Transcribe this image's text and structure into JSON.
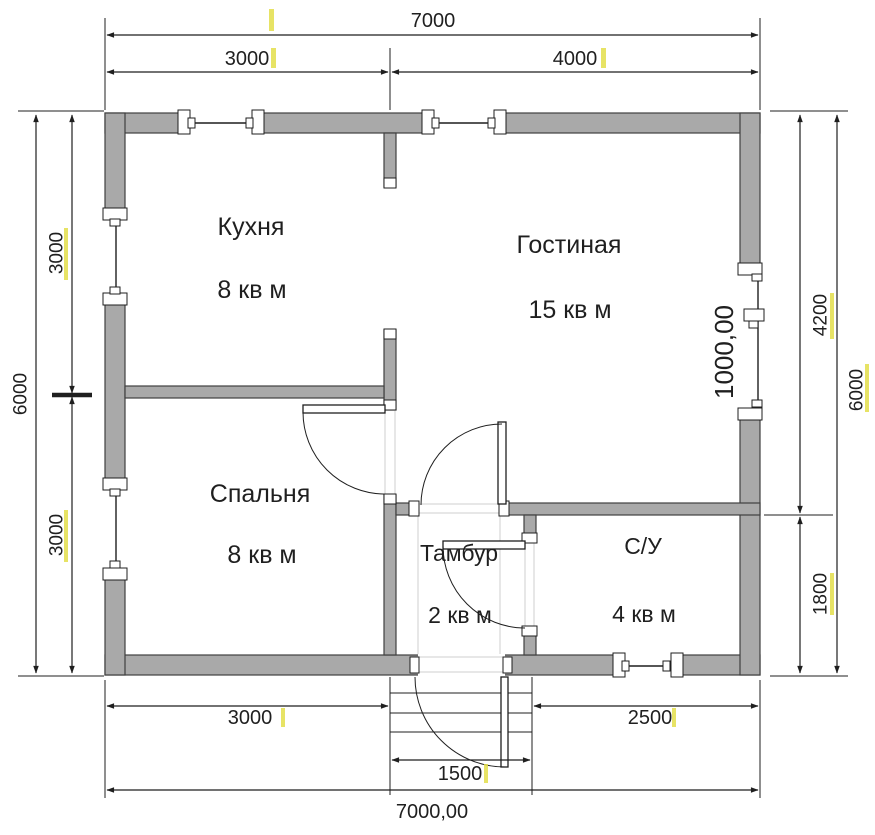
{
  "colors": {
    "wall_fill": "#a9a9a9",
    "wall_stroke": "#3f3f3f",
    "line": "#1f1f1f",
    "faint": "#cfcfcf",
    "highlight": "#e3de4a",
    "text": "#1f1f1f"
  },
  "rooms": [
    {
      "name": "Кухня",
      "area": "8 кв м",
      "name_pos": [
        251,
        226
      ],
      "area_pos": [
        252,
        289
      ],
      "font": 25
    },
    {
      "name": "Гостиная",
      "area": "15 кв м",
      "name_pos": [
        569,
        244
      ],
      "area_pos": [
        570,
        309
      ],
      "font": 25
    },
    {
      "name": "Спальня",
      "area": "8 кв м",
      "name_pos": [
        260,
        493
      ],
      "area_pos": [
        262,
        554
      ],
      "font": 25
    },
    {
      "name": "Тамбур",
      "area": "2 кв м",
      "name_pos": [
        459,
        553
      ],
      "area_pos": [
        460,
        615
      ],
      "font": 23
    },
    {
      "name": "С/У",
      "area": "4 кв м",
      "name_pos": [
        643,
        546
      ],
      "area_pos": [
        644,
        614
      ],
      "font": 23
    }
  ],
  "dimensions": [
    {
      "label": "7000",
      "line": [
        107,
        35,
        758,
        35
      ],
      "text": [
        433,
        27
      ],
      "font": 20,
      "rot": 0,
      "hl": [
        269,
        9,
        5,
        22
      ]
    },
    {
      "label": "3000",
      "line": [
        107,
        72,
        388,
        72
      ],
      "text": [
        247,
        65
      ],
      "font": 20,
      "rot": 0,
      "hl": [
        271,
        48,
        5,
        20
      ]
    },
    {
      "label": "4000",
      "line": [
        392,
        72,
        758,
        72
      ],
      "text": [
        575,
        65
      ],
      "font": 20,
      "rot": 0,
      "hl": [
        601,
        48,
        5,
        20
      ]
    },
    {
      "label": "6000",
      "line": [
        36,
        115,
        36,
        673
      ],
      "text": [
        20,
        394
      ],
      "font": 19,
      "rot": -90,
      "hl": null
    },
    {
      "label": "3000",
      "line": [
        72,
        115,
        72,
        393
      ],
      "text": [
        56,
        253
      ],
      "font": 19,
      "rot": -90,
      "hl": [
        64,
        228,
        4,
        52
      ]
    },
    {
      "label": "3000",
      "line": [
        72,
        397,
        72,
        673
      ],
      "text": [
        56,
        535
      ],
      "font": 19,
      "rot": -90,
      "hl": [
        64,
        510,
        4,
        52
      ]
    },
    {
      "label": "4200",
      "line": [
        800,
        115,
        800,
        513
      ],
      "text": [
        820,
        315
      ],
      "font": 19,
      "rot": -90,
      "hl": [
        830,
        293,
        4,
        46
      ]
    },
    {
      "label": "1800",
      "line": [
        800,
        517,
        800,
        673
      ],
      "text": [
        820,
        594
      ],
      "font": 19,
      "rot": -90,
      "hl": [
        830,
        573,
        4,
        42
      ]
    },
    {
      "label": "6000",
      "line": [
        837,
        115,
        837,
        673
      ],
      "text": [
        856,
        390
      ],
      "font": 19,
      "rot": -90,
      "hl": [
        865,
        364,
        4,
        48
      ]
    },
    {
      "label": "1000,00",
      "line": null,
      "text": [
        724,
        352
      ],
      "font": 26,
      "rot": -90,
      "hl": null
    },
    {
      "label": "3000",
      "line": [
        107,
        706,
        388,
        706
      ],
      "text": [
        250,
        724
      ],
      "font": 20,
      "rot": 0,
      "hl": [
        281,
        708,
        4,
        19
      ]
    },
    {
      "label": "2500",
      "line": [
        534,
        706,
        758,
        706
      ],
      "text": [
        650,
        724
      ],
      "font": 20,
      "rot": 0,
      "hl": [
        672,
        708,
        4,
        19
      ]
    },
    {
      "label": "1500",
      "line": [
        392,
        760,
        530,
        760
      ],
      "text": [
        460,
        780
      ],
      "font": 20,
      "rot": 0,
      "hl": [
        484,
        764,
        4,
        19
      ]
    },
    {
      "label": "7000,00",
      "line": [
        107,
        790,
        758,
        790
      ],
      "text": [
        432,
        818
      ],
      "font": 20,
      "rot": 0,
      "hl": null
    }
  ],
  "geometry": {
    "walls": [
      [
        105,
        113,
        655,
        20
      ],
      [
        105,
        655,
        655,
        20
      ],
      [
        105,
        113,
        20,
        562
      ],
      [
        740,
        113,
        20,
        562
      ],
      [
        384,
        133,
        12,
        54
      ],
      [
        384,
        330,
        12,
        80
      ],
      [
        384,
        495,
        12,
        160
      ],
      [
        125,
        386,
        259,
        12
      ],
      [
        396,
        503,
        22,
        12
      ],
      [
        500,
        503,
        260,
        12
      ],
      [
        524,
        515,
        12,
        27
      ],
      [
        524,
        628,
        12,
        27
      ]
    ],
    "opening_masks": [
      [
        185,
        111,
        68,
        24
      ],
      [
        429,
        111,
        67,
        24
      ],
      [
        103,
        220,
        24,
        75
      ],
      [
        103,
        490,
        24,
        80
      ],
      [
        739,
        275,
        24,
        135
      ],
      [
        621,
        653,
        52,
        24
      ],
      [
        418,
        653,
        87,
        24
      ]
    ],
    "faint_lines": [
      [
        385,
        410,
        385,
        494
      ],
      [
        395,
        410,
        395,
        494
      ],
      [
        419,
        504,
        499,
        504
      ],
      [
        419,
        513,
        499,
        513
      ],
      [
        525,
        543,
        525,
        627
      ],
      [
        534,
        543,
        534,
        627
      ],
      [
        419,
        657,
        504,
        657
      ],
      [
        419,
        672,
        504,
        672
      ],
      [
        500,
        516,
        500,
        654
      ],
      [
        418,
        516,
        418,
        654
      ]
    ],
    "glass_lines": [
      [
        192,
        123,
        249,
        123
      ],
      [
        436,
        123,
        490,
        123
      ],
      [
        116,
        225,
        116,
        289
      ],
      [
        116,
        495,
        116,
        563
      ],
      [
        758,
        281,
        758,
        309
      ],
      [
        758,
        321,
        758,
        402
      ],
      [
        628,
        666,
        664,
        666
      ]
    ],
    "thin_lines": [
      [
        105,
        18,
        105,
        110
      ],
      [
        760,
        18,
        760,
        110
      ],
      [
        390,
        48,
        390,
        110
      ],
      [
        18,
        111,
        104,
        111
      ],
      [
        18,
        676,
        104,
        676
      ],
      [
        770,
        111,
        848,
        111
      ],
      [
        770,
        676,
        848,
        676
      ],
      [
        764,
        515,
        833,
        515
      ],
      [
        105,
        680,
        105,
        798
      ],
      [
        760,
        680,
        760,
        798
      ],
      [
        390,
        677,
        390,
        795
      ],
      [
        532,
        677,
        532,
        795
      ],
      [
        390,
        693,
        532,
        693
      ],
      [
        390,
        713,
        532,
        713
      ],
      [
        390,
        732,
        532,
        732
      ]
    ],
    "thick_ticks": [
      [
        52,
        395,
        92,
        395
      ]
    ],
    "fixtures": [
      [
        178,
        110,
        12,
        24
      ],
      [
        252,
        110,
        12,
        24
      ],
      [
        188,
        118,
        7,
        10
      ],
      [
        246,
        118,
        7,
        10
      ],
      [
        422,
        110,
        12,
        24
      ],
      [
        494,
        110,
        12,
        24
      ],
      [
        432,
        118,
        7,
        10
      ],
      [
        488,
        118,
        7,
        10
      ],
      [
        103,
        208,
        24,
        12
      ],
      [
        103,
        293,
        24,
        12
      ],
      [
        110,
        219,
        10,
        7
      ],
      [
        110,
        287,
        10,
        7
      ],
      [
        103,
        478,
        24,
        12
      ],
      [
        103,
        568,
        24,
        12
      ],
      [
        110,
        489,
        10,
        7
      ],
      [
        110,
        561,
        10,
        7
      ],
      [
        738,
        263,
        24,
        12
      ],
      [
        738,
        408,
        24,
        12
      ],
      [
        744,
        309,
        20,
        12
      ],
      [
        752,
        274,
        10,
        7
      ],
      [
        752,
        400,
        10,
        7
      ],
      [
        749,
        321,
        9,
        7
      ],
      [
        613,
        653,
        12,
        24
      ],
      [
        671,
        653,
        12,
        24
      ],
      [
        622,
        661,
        7,
        10
      ],
      [
        663,
        661,
        7,
        10
      ],
      [
        384,
        178,
        12,
        10
      ],
      [
        384,
        329,
        12,
        10
      ],
      [
        384,
        400,
        12,
        10
      ],
      [
        384,
        494,
        12,
        10
      ],
      [
        409,
        501,
        10,
        15
      ],
      [
        499,
        501,
        10,
        15
      ],
      [
        522,
        533,
        15,
        10
      ],
      [
        522,
        626,
        15,
        10
      ],
      [
        410,
        657,
        9,
        16
      ],
      [
        503,
        657,
        9,
        16
      ]
    ],
    "door_leaves": [
      [
        303,
        405,
        82,
        8
      ],
      [
        498,
        422,
        8,
        82
      ],
      [
        443,
        541,
        82,
        8
      ],
      [
        501,
        677,
        7,
        90
      ]
    ],
    "door_arcs": [
      "M303,412 A82,82 0 0 0 385,494",
      "M502,424 A81,81 0 0 0 421,505",
      "M443,546 A82,82 0 0 0 525,628",
      "M415,677 A90,90 0 0 0 505,767"
    ]
  }
}
